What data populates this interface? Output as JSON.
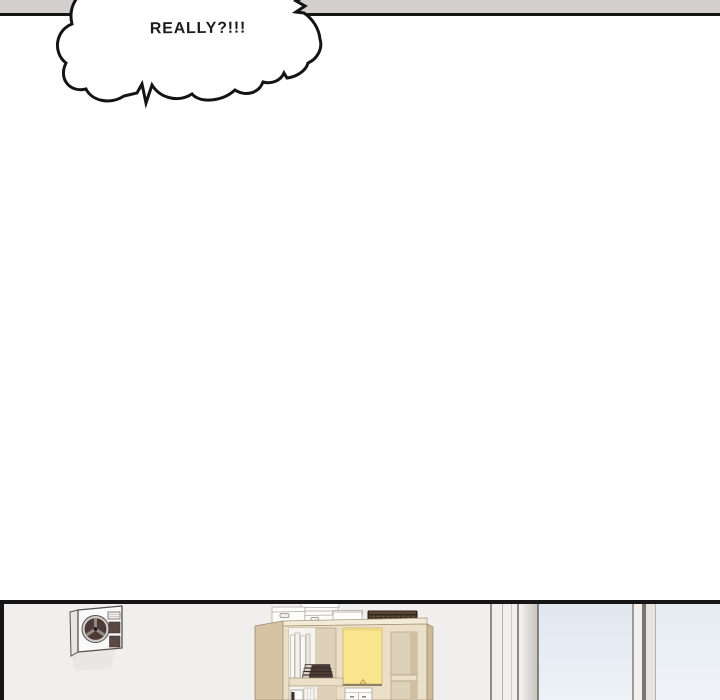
{
  "speech_bubble": {
    "text": "REALLY?!!!"
  },
  "colors": {
    "panel_border": "#161616",
    "top_bar": "#d2cfce",
    "bubble_fill": "#ffffff",
    "bubble_stroke": "#141414",
    "wall": "#f1efed",
    "shelf_cream": "#ebdfc7",
    "shelf_top": "#f3ebd8",
    "shelf_side": "#d6c3a4",
    "shelf_side_dark": "#ccb998",
    "cube_tan": "#ddd1ba",
    "cube_white": "#f6f3ee",
    "yellow_door": "#f8e58e",
    "basket": "#443426",
    "book_dark": "#4a3b36",
    "ac_body": "#fbfafa",
    "ac_fan_dark": "#4e3b38",
    "glass_top": "#e0e7ef",
    "glass_bottom": "#edf2f7",
    "frame_line": "#8f8b87",
    "shadow": "#e8e5e2"
  }
}
